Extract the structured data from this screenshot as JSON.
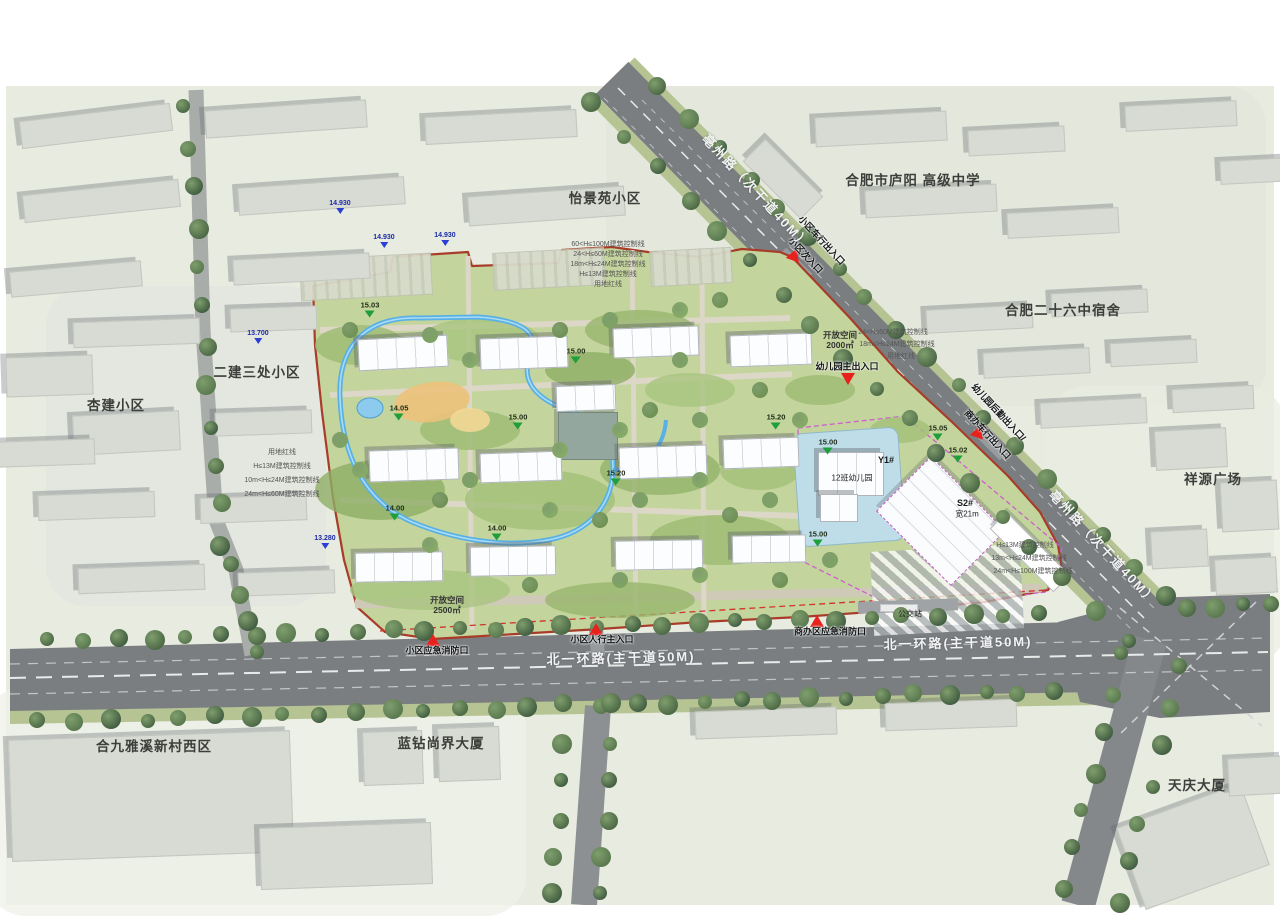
{
  "colors": {
    "ground": "#e7ebe0",
    "road": "#7b7e81",
    "site_fill": "#c3d49c",
    "boundary_red": "#a83c28",
    "entrance_red": "#e8211d",
    "stream_blue": "#58b0e4",
    "elev_green": "#1f9e3c",
    "elev_blue": "#2b3fd4"
  },
  "context": {
    "area_labels": [
      {
        "t": "怡景苑小区",
        "x": 605,
        "y": 197
      },
      {
        "t": "合肥市庐阳 高级中学",
        "x": 913,
        "y": 179
      },
      {
        "t": "合肥二十六中宿舍",
        "x": 1063,
        "y": 309
      },
      {
        "t": "祥源广场",
        "x": 1213,
        "y": 478
      },
      {
        "t": "二建三处小区",
        "x": 257,
        "y": 371
      },
      {
        "t": "杏建小区",
        "x": 116,
        "y": 404
      },
      {
        "t": "合九雅溪新村西区",
        "x": 154,
        "y": 745
      },
      {
        "t": "蓝钻尚界大厦",
        "x": 441,
        "y": 742
      },
      {
        "t": "天庆大厦",
        "x": 1197,
        "y": 784
      }
    ],
    "buildings": [
      [
        95,
        125,
        150,
        26,
        -7
      ],
      [
        285,
        118,
        160,
        26,
        -4
      ],
      [
        500,
        126,
        150,
        26,
        -3
      ],
      [
        100,
        200,
        155,
        26,
        -6
      ],
      [
        320,
        195,
        165,
        26,
        -4
      ],
      [
        545,
        205,
        155,
        28,
        -4
      ],
      [
        75,
        278,
        130,
        24,
        -5
      ],
      [
        300,
        268,
        135,
        24,
        -3
      ],
      [
        880,
        128,
        130,
        28,
        -3
      ],
      [
        1015,
        140,
        95,
        24,
        -3
      ],
      [
        930,
        200,
        130,
        26,
        -3
      ],
      [
        1062,
        222,
        110,
        24,
        -3
      ],
      [
        782,
        178,
        80,
        30,
        45
      ],
      [
        1180,
        115,
        110,
        24,
        -3
      ],
      [
        1255,
        170,
        70,
        22,
        -3
      ],
      [
        978,
        318,
        105,
        22,
        -3
      ],
      [
        1098,
        302,
        95,
        22,
        -3
      ],
      [
        1035,
        362,
        105,
        24,
        -3
      ],
      [
        1152,
        352,
        85,
        22,
        -3
      ],
      [
        1092,
        412,
        105,
        24,
        -3
      ],
      [
        1212,
        398,
        80,
        22,
        -3
      ],
      [
        1190,
        448,
        70,
        38,
        -3
      ],
      [
        1248,
        505,
        55,
        48,
        -3
      ],
      [
        1178,
        548,
        55,
        36,
        -3
      ],
      [
        1245,
        575,
        60,
        34,
        -3
      ],
      [
        135,
        332,
        125,
        24,
        -2
      ],
      [
        272,
        318,
        85,
        22,
        -2
      ],
      [
        125,
        432,
        105,
        38,
        -3
      ],
      [
        262,
        422,
        95,
        22,
        -2
      ],
      [
        95,
        505,
        115,
        24,
        -2
      ],
      [
        252,
        508,
        105,
        24,
        -2
      ],
      [
        140,
        578,
        125,
        24,
        -2
      ],
      [
        285,
        582,
        95,
        22,
        -2
      ],
      [
        48,
        375,
        85,
        38,
        -2
      ],
      [
        45,
        452,
        95,
        24,
        -2
      ],
      [
        150,
        795,
        280,
        120,
        -2
      ],
      [
        345,
        855,
        170,
        60,
        -2
      ],
      [
        392,
        757,
        58,
        52,
        -2
      ],
      [
        468,
        753,
        60,
        52,
        -2
      ],
      [
        765,
        722,
        140,
        26,
        -2
      ],
      [
        950,
        714,
        130,
        26,
        -2
      ],
      [
        1192,
        845,
        130,
        85,
        -20
      ],
      [
        1255,
        775,
        55,
        36,
        -3
      ]
    ],
    "tree_rows": [
      [
        50,
        641,
        1040,
        613,
        30
      ],
      [
        40,
        722,
        1055,
        691,
        30
      ],
      [
        660,
        88,
        1163,
        597,
        18
      ],
      [
        594,
        104,
        1126,
        642,
        18
      ],
      [
        186,
        108,
        222,
        545,
        12
      ],
      [
        234,
        566,
        254,
        650,
        4
      ],
      [
        566,
        705,
        552,
        895,
        6
      ],
      [
        614,
        705,
        600,
        895,
        6
      ],
      [
        1124,
        655,
        1062,
        888,
        7
      ],
      [
        1182,
        668,
        1118,
        902,
        7
      ],
      [
        1190,
        610,
        1268,
        602,
        4
      ]
    ]
  },
  "roads": {
    "labels": [
      {
        "t": "亳州路（次干道40M）",
        "x": 757,
        "y": 191,
        "rot": 47
      },
      {
        "t": "亳州路（次干道40M）",
        "x": 1104,
        "y": 547,
        "rot": 47
      },
      {
        "t": "北一环路(主干道50M)",
        "x": 621,
        "y": 657,
        "rot": -1.3
      },
      {
        "t": "北一环路(主干道50M)",
        "x": 958,
        "y": 642,
        "rot": -1.3
      }
    ]
  },
  "site": {
    "buildings": [
      [
        402,
        352,
        88,
        30,
        -3
      ],
      [
        523,
        352,
        86,
        30,
        -2
      ],
      [
        655,
        341,
        84,
        28,
        -2
      ],
      [
        770,
        349,
        80,
        30,
        -2
      ],
      [
        413,
        464,
        88,
        30,
        -2
      ],
      [
        520,
        466,
        80,
        28,
        -2
      ],
      [
        662,
        461,
        86,
        30,
        -2
      ],
      [
        760,
        452,
        74,
        28,
        -2
      ],
      [
        398,
        566,
        86,
        28,
        -1
      ],
      [
        512,
        560,
        84,
        28,
        -1
      ],
      [
        658,
        554,
        86,
        28,
        -1
      ],
      [
        768,
        548,
        72,
        26,
        -1
      ],
      [
        585,
        397,
        58,
        24,
        -2
      ]
    ],
    "patches": [
      [
        360,
        345,
        90,
        40,
        "#9cba72"
      ],
      [
        480,
        340,
        120,
        44,
        "#a8c47e"
      ],
      [
        640,
        330,
        110,
        40,
        "#97b56d"
      ],
      [
        380,
        490,
        130,
        60,
        "#8fae66"
      ],
      [
        540,
        500,
        150,
        60,
        "#a3bf78"
      ],
      [
        660,
        470,
        120,
        50,
        "#93b36a"
      ],
      [
        720,
        540,
        140,
        50,
        "#9cba72"
      ],
      [
        430,
        590,
        160,
        40,
        "#a8c47e"
      ],
      [
        620,
        600,
        150,
        36,
        "#97b56d"
      ],
      [
        850,
        500,
        100,
        60,
        "#b7d39a"
      ],
      [
        760,
        470,
        80,
        40,
        "#a3bf78"
      ],
      [
        590,
        370,
        90,
        36,
        "#8fae66"
      ],
      [
        470,
        430,
        100,
        40,
        "#9cba72"
      ],
      [
        690,
        390,
        90,
        34,
        "#a8c47e"
      ],
      [
        820,
        390,
        70,
        30,
        "#9cba72"
      ],
      [
        900,
        430,
        60,
        26,
        "#a3bf78"
      ]
    ],
    "parking": [
      [
        365,
        276,
        130,
        40
      ],
      [
        548,
        268,
        110,
        36
      ],
      [
        690,
        266,
        80,
        34
      ]
    ],
    "trees": [
      [
        350,
        330
      ],
      [
        430,
        335
      ],
      [
        470,
        360
      ],
      [
        560,
        330
      ],
      [
        610,
        320
      ],
      [
        680,
        310
      ],
      [
        720,
        300
      ],
      [
        340,
        440
      ],
      [
        360,
        470
      ],
      [
        440,
        500
      ],
      [
        470,
        480
      ],
      [
        550,
        510
      ],
      [
        600,
        520
      ],
      [
        640,
        500
      ],
      [
        700,
        480
      ],
      [
        730,
        515
      ],
      [
        770,
        500
      ],
      [
        620,
        430
      ],
      [
        650,
        410
      ],
      [
        700,
        420
      ],
      [
        430,
        545
      ],
      [
        530,
        585
      ],
      [
        620,
        580
      ],
      [
        700,
        575
      ],
      [
        780,
        580
      ],
      [
        830,
        560
      ],
      [
        800,
        420
      ],
      [
        760,
        390
      ],
      [
        680,
        360
      ],
      [
        560,
        450
      ]
    ],
    "entrances": [
      {
        "x": 795,
        "y": 258,
        "rot": 140,
        "labels": [
          {
            "t": "小区车行出入口",
            "x": 822,
            "y": 240,
            "rot": 47
          },
          {
            "t": "小区次入口",
            "x": 806,
            "y": 255,
            "rot": 47
          }
        ]
      },
      {
        "x": 848,
        "y": 379,
        "rot": 180,
        "labels": [
          {
            "t": "幼儿园主出入口",
            "x": 847,
            "y": 366,
            "rot": 0
          }
        ]
      },
      {
        "x": 979,
        "y": 435,
        "rot": 140,
        "labels": [
          {
            "t": "幼儿园后勤出入口/",
            "x": 999,
            "y": 412,
            "rot": 47
          },
          {
            "t": "商办车行出入口",
            "x": 988,
            "y": 434,
            "rot": 47
          }
        ]
      },
      {
        "x": 433,
        "y": 640,
        "rot": 0,
        "labels": [
          {
            "t": "小区应急消防口",
            "x": 437,
            "y": 650,
            "rot": 0
          }
        ]
      },
      {
        "x": 596,
        "y": 629,
        "rot": 0,
        "labels": [
          {
            "t": "小区人行主入口",
            "x": 602,
            "y": 639,
            "rot": 0
          }
        ]
      },
      {
        "x": 817,
        "y": 621,
        "rot": 0,
        "labels": [
          {
            "t": "商办区应急消防口",
            "x": 830,
            "y": 631,
            "rot": 0
          }
        ]
      }
    ],
    "elev_green": [
      [
        370,
        317,
        "15.03"
      ],
      [
        576,
        363,
        "15.00"
      ],
      [
        399,
        420,
        "14.05"
      ],
      [
        518,
        429,
        "15.00"
      ],
      [
        395,
        520,
        "14.00"
      ],
      [
        497,
        540,
        "14.00"
      ],
      [
        616,
        485,
        "15.20"
      ],
      [
        776,
        429,
        "15.20"
      ],
      [
        828,
        454,
        "15.00"
      ],
      [
        938,
        440,
        "15.05"
      ],
      [
        958,
        462,
        "15.02"
      ],
      [
        818,
        546,
        "15.00"
      ]
    ],
    "elev_blue": [
      [
        340,
        214,
        "14.930"
      ],
      [
        384,
        248,
        "14.930"
      ],
      [
        445,
        246,
        "14.930"
      ],
      [
        258,
        344,
        "13.700"
      ],
      [
        325,
        549,
        "13.280"
      ]
    ],
    "small_labels": [
      {
        "t": "开放空间",
        "x": 447,
        "y": 600,
        "c": "os"
      },
      {
        "t": "2500㎡",
        "x": 447,
        "y": 610,
        "c": "os"
      },
      {
        "t": "开放空间",
        "x": 840,
        "y": 335,
        "c": "os"
      },
      {
        "t": "2000㎡",
        "x": 840,
        "y": 345,
        "c": "os"
      },
      {
        "t": "公交站",
        "x": 910,
        "y": 614,
        "c": "poi"
      },
      {
        "t": "12班幼儿园",
        "x": 852,
        "y": 478,
        "c": "poi"
      },
      {
        "t": "Y1#",
        "x": 886,
        "y": 460,
        "c": "poib"
      },
      {
        "t": "S2#",
        "x": 965,
        "y": 503,
        "c": "poib"
      },
      {
        "t": "宽21m",
        "x": 967,
        "y": 514,
        "c": "poi"
      },
      {
        "t": "60<H≤100M建筑控制线",
        "x": 608,
        "y": 244,
        "c": "sb"
      },
      {
        "t": "24<H≤60M建筑控制线",
        "x": 608,
        "y": 254,
        "c": "sb"
      },
      {
        "t": "18m<H≤24M建筑控制线",
        "x": 608,
        "y": 264,
        "c": "sb"
      },
      {
        "t": "H≤13M建筑控制线",
        "x": 608,
        "y": 274,
        "c": "sb"
      },
      {
        "t": "用地红线",
        "x": 608,
        "y": 284,
        "c": "sb"
      },
      {
        "t": "24<H≤60M建筑控制线",
        "x": 893,
        "y": 332,
        "c": "sb"
      },
      {
        "t": "18m<H≤24M建筑控制线",
        "x": 897,
        "y": 344,
        "c": "sb"
      },
      {
        "t": "用地红线",
        "x": 901,
        "y": 356,
        "c": "sb"
      },
      {
        "t": "用地红线",
        "x": 282,
        "y": 452,
        "c": "sb"
      },
      {
        "t": "H≤13M建筑控制线",
        "x": 282,
        "y": 466,
        "c": "sb"
      },
      {
        "t": "10m<H≤24M建筑控制线",
        "x": 282,
        "y": 480,
        "c": "sb"
      },
      {
        "t": "24m<H≤60M建筑控制线",
        "x": 282,
        "y": 494,
        "c": "sb"
      },
      {
        "t": "H≤13M建筑控制线",
        "x": 1025,
        "y": 545,
        "c": "sb"
      },
      {
        "t": "13m<H≤24M建筑控制线",
        "x": 1029,
        "y": 558,
        "c": "sb"
      },
      {
        "t": "24m<H≤100M建筑控制线",
        "x": 1033,
        "y": 571,
        "c": "sb"
      }
    ]
  }
}
